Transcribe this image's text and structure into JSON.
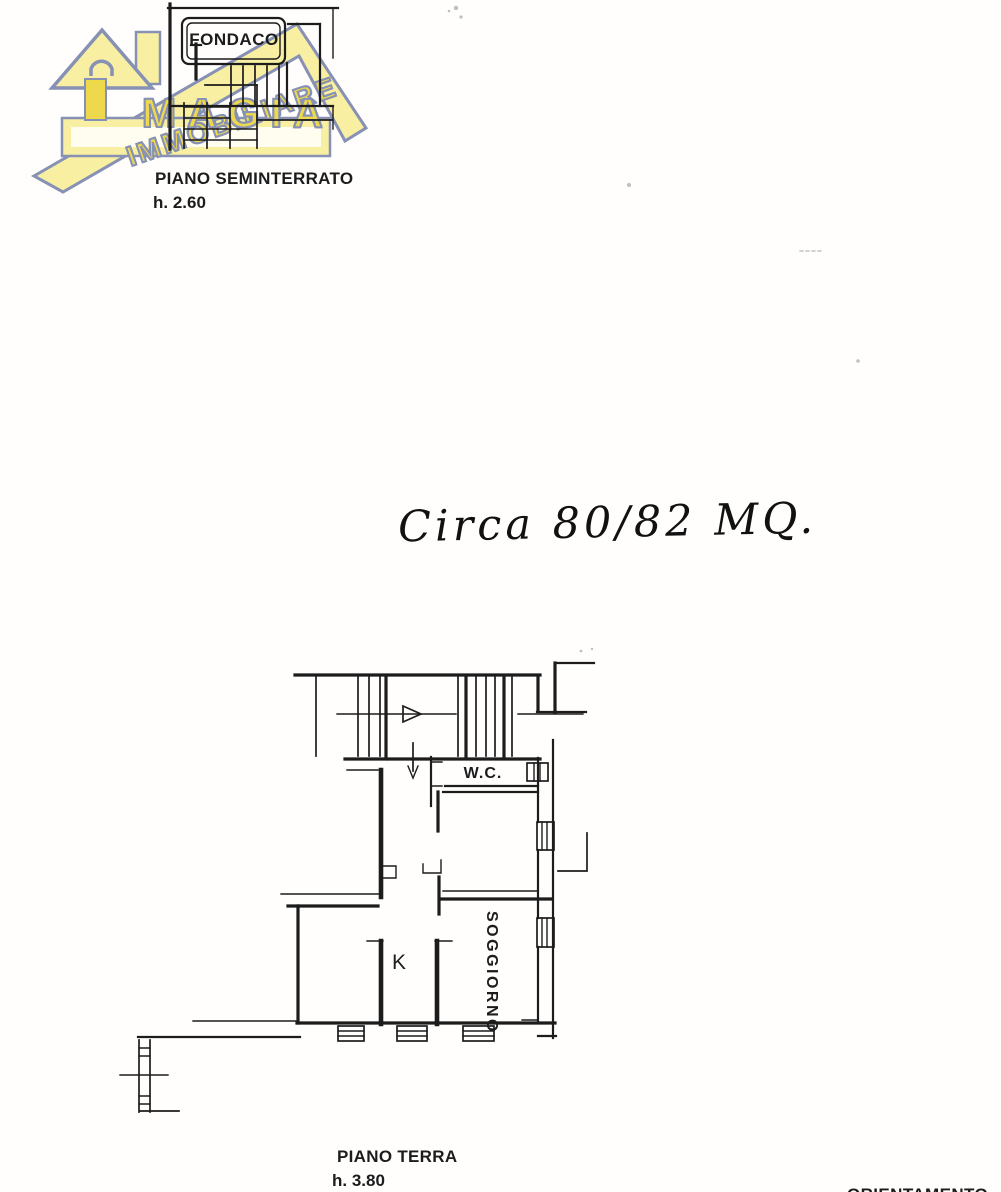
{
  "doc": {
    "seminterrato": {
      "room": "FONDACO",
      "title": "PIANO SEMINTERRATO",
      "height": "h. 2.60"
    },
    "note": "Circa 80/82 MQ.",
    "terra": {
      "wc": "W.C.",
      "kitchen": "K",
      "living": "SOGGIORNO",
      "title": "PIANO TERRA",
      "height": "h. 3.80"
    },
    "orientation": "ORIENTAMENTO",
    "logo": {
      "top": "IMMOBILIARE",
      "bottom": "MAGIA"
    }
  },
  "colors": {
    "logo_yellow": "#eed94d",
    "logo_pale": "#f8efa2",
    "logo_outline": "#8691b4",
    "ink": "#1c1c1c"
  }
}
